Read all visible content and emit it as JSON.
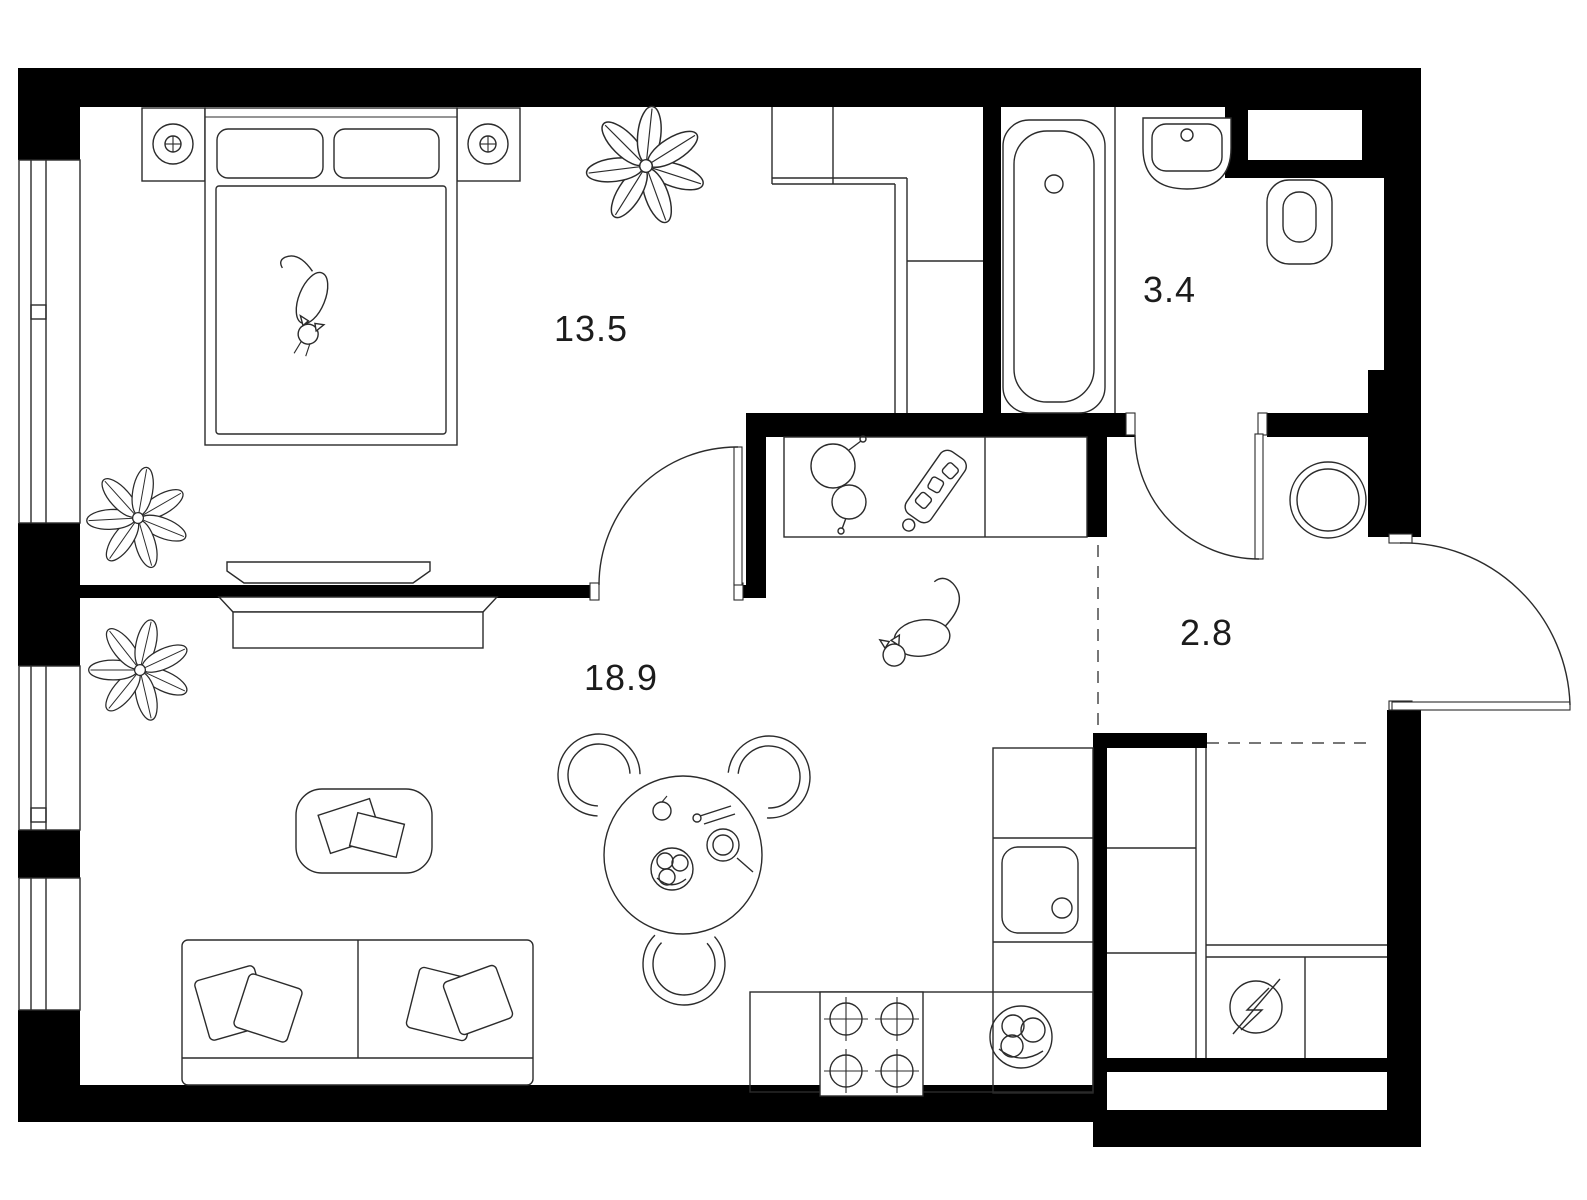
{
  "document": {
    "type": "apartment-floor-plan",
    "background_color": "#ffffff",
    "wall_color": "#000000",
    "line_color": "#2b2b2b",
    "text_color": "#1c1c1c"
  },
  "rooms": {
    "bedroom": {
      "name": "bedroom",
      "label": "13.5"
    },
    "living_kitchen": {
      "name": "living-room-kitchen",
      "label": "18.9"
    },
    "bathroom": {
      "name": "bathroom",
      "label": "3.4"
    },
    "hallway": {
      "name": "hallway",
      "label": "2.8"
    }
  },
  "icons": {
    "furniture": [
      "double-bed",
      "pillow",
      "nightstand-lamp-left",
      "nightstand-lamp-right",
      "cat-on-bed",
      "built-in-closet",
      "potted-plant",
      "tv-on-wall",
      "tv-console",
      "coffee-table-with-magazines",
      "sofa-with-pillows",
      "round-dining-table",
      "dining-chair",
      "fruit-bowl",
      "plate-with-fork",
      "apple",
      "cutlery",
      "cat-on-floor"
    ],
    "kitchen": [
      "kitchen-counter",
      "saucepan",
      "frying-pan",
      "cutting-board",
      "cooktop-four-burners",
      "kitchen-sink-square",
      "fruit-bowl-on-counter"
    ],
    "bathroom": [
      "bathtub",
      "wash-basin",
      "toilet",
      "washing-machine"
    ],
    "storage": [
      "wardrobe-shelving",
      "electrical-panel-symbol"
    ],
    "openings": [
      "bedroom-door-arc",
      "bathroom-door-arc",
      "entrance-door-arc",
      "window-triple-left-wall"
    ]
  }
}
